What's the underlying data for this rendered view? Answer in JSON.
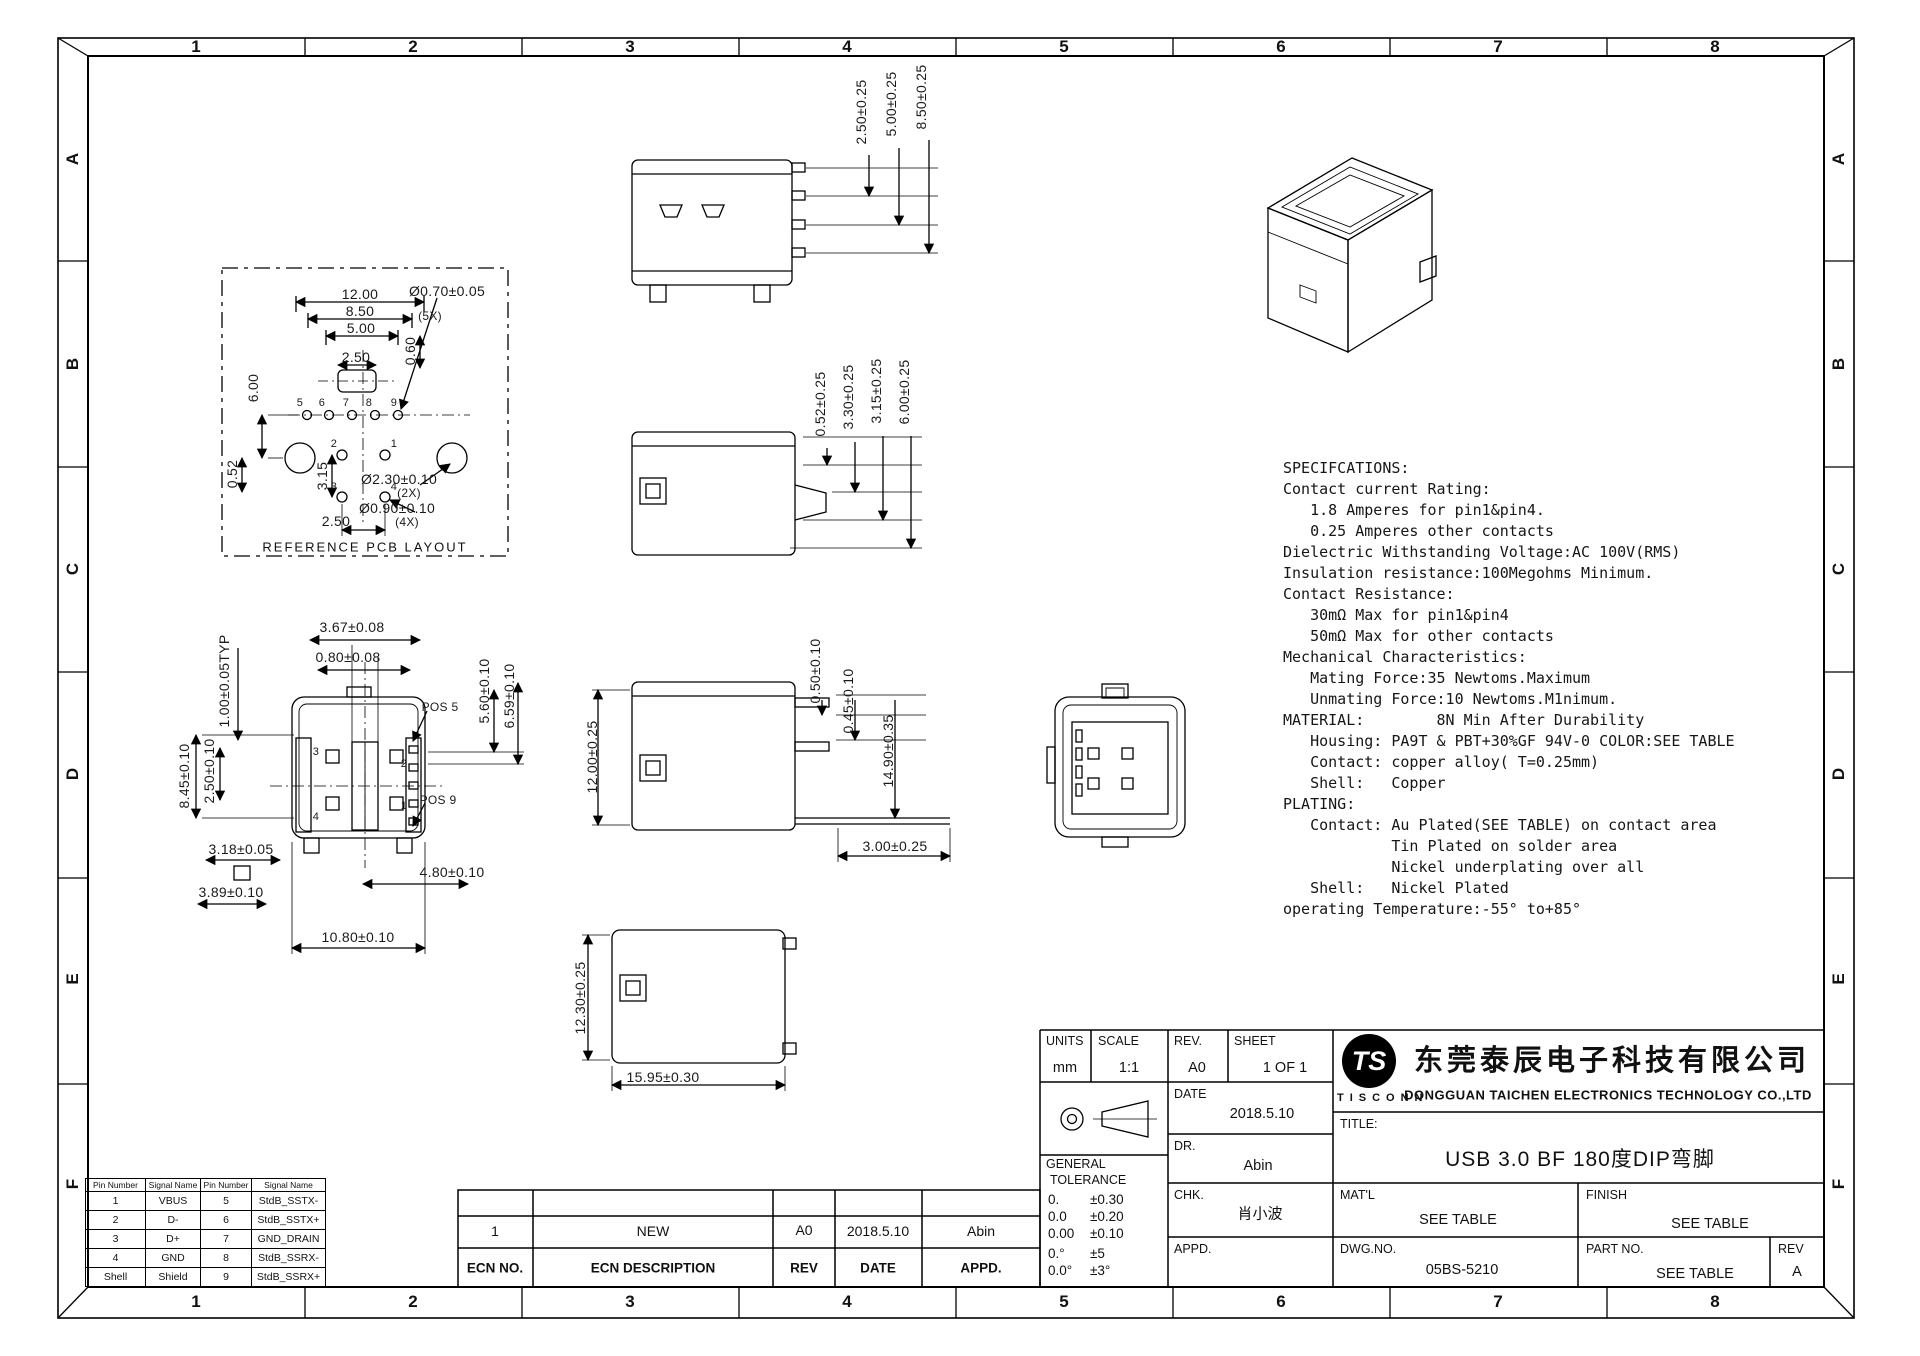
{
  "frame": {
    "columns": [
      "1",
      "2",
      "3",
      "4",
      "5",
      "6",
      "7",
      "8"
    ],
    "rows": [
      "A",
      "B",
      "C",
      "D",
      "E",
      "F"
    ]
  },
  "pcb": {
    "caption": "REFERENCE PCB LAYOUT",
    "labels": [
      "12.00",
      "8.50",
      "5.00",
      "2.50",
      "0.60",
      "Ø0.70±0.05",
      "(5X)",
      "6.00",
      "0.52",
      "3.15",
      "Ø2.30±0.10",
      "(2X)",
      "Ø0.90±0.10",
      "(4X)",
      "2.50"
    ],
    "pins": [
      "5",
      "6",
      "7",
      "8",
      "9",
      "2",
      "1",
      "3",
      "4"
    ]
  },
  "dims": {
    "top_view": [
      "2.50±0.25",
      "5.00±0.25",
      "8.50±0.25"
    ],
    "mid_view": [
      "0.52±0.25",
      "3.30±0.25",
      "3.15±0.25",
      "6.00±0.25"
    ],
    "lower_view": [
      "0.50±0.10",
      "0.45±0.10",
      "14.90±0.35",
      "12.00±0.25",
      "3.00±0.25"
    ],
    "bottom_view": [
      "12.30±0.25",
      "15.95±0.30"
    ],
    "front_view": [
      "3.67±0.08",
      "0.80±0.08",
      "1.00±0.05TYP",
      "8.45±0.10",
      "2.50±0.10",
      "5.60±0.10",
      "6.59±0.10",
      "3.18±0.05",
      "4.80±0.10",
      "3.89±0.10",
      "10.80±0.10",
      "POS 5",
      "POS 9"
    ],
    "front_pins": [
      "3",
      "2",
      "4",
      "1"
    ]
  },
  "specifications": {
    "lines": [
      "SPECIFCATIONS:",
      "Contact current Rating:",
      "   1.8 Amperes for pin1&pin4.",
      "   0.25 Amperes other contacts",
      "Dielectric Withstanding Voltage:AC 100V(RMS)",
      "Insulation resistance:100Megohms Minimum.",
      "Contact Resistance:",
      "   30mΩ Max for pin1&pin4",
      "   50mΩ Max for other contacts",
      "Mechanical Characteristics:",
      "   Mating Force:35 Newtoms.Maximum",
      "   Unmating Force:10 Newtoms.M1nimum.",
      "MATERIAL:        8N Min After Durability",
      "   Housing: PA9T & PBT+30%GF 94V-0 COLOR:SEE TABLE",
      "   Contact: copper alloy( T=0.25mm)",
      "   Shell:   Copper",
      "PLATING:",
      "   Contact: Au Plated(SEE TABLE) on contact area",
      "            Tin Plated on solder area",
      "            Nickel underplating over all",
      "   Shell:   Nickel Plated",
      "operating Temperature:-55° to+85°"
    ]
  },
  "pin_table": {
    "headers": [
      "Pin Number",
      "Signal Name",
      "Pin Number",
      "Signal Name"
    ],
    "rows": [
      [
        "1",
        "VBUS",
        "5",
        "StdB_SSTX-"
      ],
      [
        "2",
        "D-",
        "6",
        "StdB_SSTX+"
      ],
      [
        "3",
        "D+",
        "7",
        "GND_DRAIN"
      ],
      [
        "4",
        "GND",
        "8",
        "StdB_SSRX-"
      ],
      [
        "Shell",
        "Shield",
        "9",
        "StdB_SSRX+"
      ]
    ]
  },
  "ecn": {
    "headers": [
      "ECN NO.",
      "ECN DESCRIPTION",
      "REV",
      "DATE",
      "APPD."
    ],
    "row": [
      "1",
      "NEW",
      "A0",
      "2018.5.10",
      "Abin"
    ]
  },
  "title_block": {
    "units_label": "UNITS",
    "units_value": "mm",
    "scale_label": "SCALE",
    "scale_value": "1:1",
    "rev_label": "REV.",
    "rev_value": "A0",
    "sheet_label": "SHEET",
    "sheet_value": "1 OF 1",
    "date_label": "DATE",
    "date_value": "2018.5.10",
    "dr_label": "DR.",
    "dr_value": "Abin",
    "chk_label": "CHK.",
    "chk_value": "肖小波",
    "appd_label": "APPD.",
    "appd_value": "",
    "title_label": "TITLE:",
    "title_value": "USB 3.0 BF 180度DIP弯脚",
    "matl_label": "MAT'L",
    "matl_value": "SEE TABLE",
    "finish_label": "FINISH",
    "finish_value": "SEE TABLE",
    "dwg_label": "DWG.NO.",
    "dwg_value": "05BS-5210",
    "part_label": "PART NO.",
    "part_value": "SEE TABLE",
    "rev2_label": "REV",
    "rev2_value": "A",
    "general_label": "GENERAL",
    "tolerance_label": "TOLERANCE",
    "tolerances": [
      [
        "0.",
        "±0.30"
      ],
      [
        "0.0",
        "±0.20"
      ],
      [
        "0.00",
        "±0.10"
      ],
      [
        "0.°",
        "±5"
      ],
      [
        "0.0°",
        "±3°"
      ]
    ]
  },
  "company": {
    "logo_monogram": "TS",
    "logo_name": "TISCONN",
    "name_cn": "东莞泰辰电子科技有限公司",
    "name_en": "DONGGUAN TAICHEN ELECTRONICS TECHNOLOGY CO.,LTD"
  }
}
